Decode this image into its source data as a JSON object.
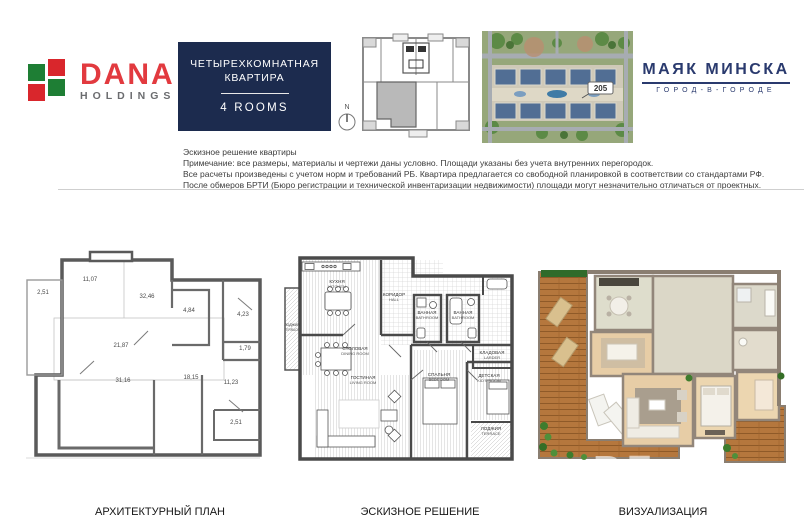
{
  "header": {
    "dana": {
      "wordmark": "DANA",
      "subtitle": "HOLDINGS",
      "color_red": "#d9262c",
      "color_green": "#1e7e34",
      "color_gray": "#6b6c6f"
    },
    "badge": {
      "line1": "ЧЕТЫРЕХКОМНАТНАЯ",
      "line2": "КВАРТИРА",
      "rooms_label": "4 ROOMS",
      "bg_color": "#1c2b4e"
    },
    "compass": {
      "north_label": "N"
    },
    "siteplan": {
      "building_label": "205"
    },
    "mayak": {
      "title": "МАЯК МИНСКА",
      "subtitle": "ГОРОД-В-ГОРОДЕ",
      "color": "#2a3a6e"
    }
  },
  "notes": {
    "lines": [
      "Эскизное решение квартиры",
      "Примечание: все размеры, материалы и чертежи даны условно. Площади указаны без учета внутренних перегородок.",
      "Все расчеты произведены с учетом норм и требований РБ. Квартира предлагается со свободной планировкой в соответствии со стандартами РФ.",
      "После обмеров БРТИ (Бюро регистрации и технической инвентаризации недвижимости) площади могут незначительно отличаться от проектных."
    ]
  },
  "arch_plan": {
    "areas": [
      "2,51",
      "11,07",
      "32,46",
      "4,84",
      "4,23",
      "21,87",
      "1,79",
      "31,16",
      "18,15",
      "11,23",
      "2,51"
    ]
  },
  "sketch_plan": {
    "rooms": [
      {
        "ru": "ЛОДЖИЯ",
        "en": "TERRACE"
      },
      {
        "ru": "КУХНЯ",
        "en": "KITCHEN"
      },
      {
        "ru": "КОРИДОР",
        "en": "HALL"
      },
      {
        "ru": "ВАННАЯ",
        "en": "BATHROOM"
      },
      {
        "ru": "ВАННАЯ",
        "en": "BATHROOM"
      },
      {
        "ru": "КЛАДОВАЯ",
        "en": "LARDER"
      },
      {
        "ru": "СТОЛОВАЯ",
        "en": "DINING ROOM"
      },
      {
        "ru": "ГОСТИНАЯ",
        "en": "LIVING ROOM"
      },
      {
        "ru": "СПАЛЬНЯ",
        "en": "BEDROOM"
      },
      {
        "ru": "ДЕТСКАЯ",
        "en": "KID'S ROOM"
      },
      {
        "ru": "ЛОДЖИЯ",
        "en": "TERRACE"
      }
    ]
  },
  "visualization": {
    "watermark": "REalt"
  },
  "captions": {
    "arch": "АРХИТЕКТУРНЫЙ ПЛАН",
    "sketch": "ЭСКИЗНОЕ РЕШЕНИЕ",
    "viz": "ВИЗУАЛИЗАЦИЯ"
  }
}
